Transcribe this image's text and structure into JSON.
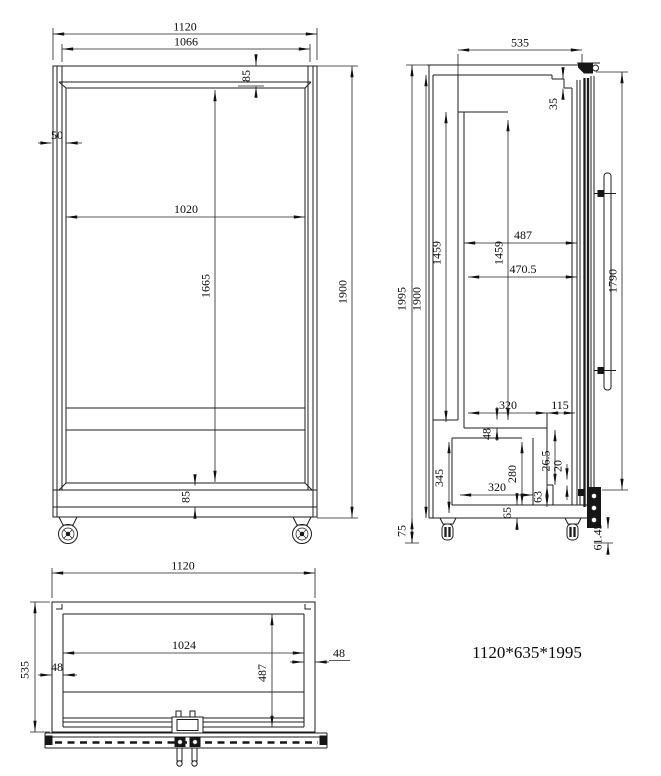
{
  "drawing": {
    "note": "1120*635*1995",
    "front": {
      "overall_width": "1120",
      "top_inner_width": "1066",
      "top_frame": "85",
      "left_frame": "50",
      "glass_width": "1020",
      "glass_height": "1665",
      "body_height": "1900",
      "bottom_frame": "85"
    },
    "side": {
      "top_depth": "535",
      "door_top_gap": "35",
      "cavity_height_back": "1459",
      "cavity_height_front": "1459",
      "cavity_depth": "487",
      "shelf_depth": "470.5",
      "door_height": "1790",
      "overall_height": "1995",
      "body_height": "1900",
      "caster_height": "75",
      "machine_top_width": "320",
      "machine_front_offset": "115",
      "floor_step": "48",
      "machine_height": "345",
      "machine_inner_height": "280",
      "machine_bottom_width": "320",
      "seal_gap": "26.5",
      "door_bottom_gap": "20",
      "base_front_height": "63",
      "base_bottom_height": "65",
      "hinge_bottom_height": "61.45"
    },
    "bottom": {
      "overall_width": "1120",
      "inner_width": "1024",
      "left_wall": "48",
      "right_wall": "48",
      "overall_depth": "535",
      "inner_depth": "487"
    }
  }
}
